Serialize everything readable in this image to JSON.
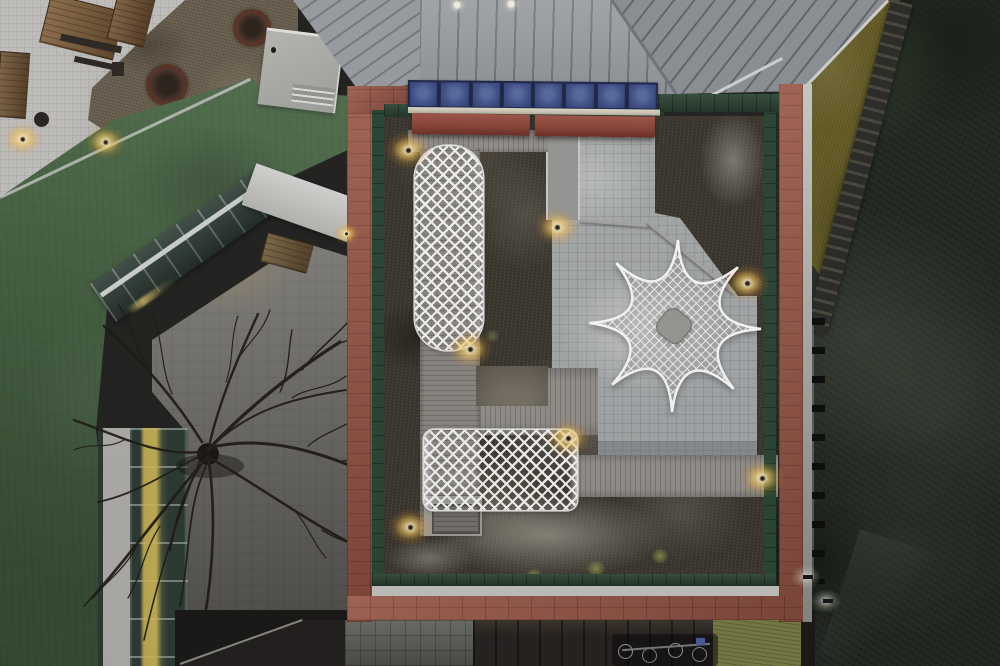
{
  "scene": {
    "description": "Dusk aerial drone photograph looking straight down at a school rooftop courtyard framed by a brick-red roof border, containing white lattice canopy structures (a long tunnel, a low rectangle and an eight-point star pavilion), pale tile paving, wooden deck paths, dry winter roof-garden beds and warm path lights; surrounded by a green sports turf, a glass atrium wing with a bare tree over a paver courtyard, a standing-seam metal roof, and a dark wooded hillside with an access stair",
    "time_of_day": "dusk",
    "view": "top-down aerial",
    "season": "winter"
  },
  "palette": {
    "metal_roof": "#9da0a3",
    "metal_roof_dark": "#909396",
    "roof_border_red": "#9c5846",
    "awning_red": "#8e4435",
    "panel_blue": "#42528b",
    "fence_green": "#2d4733",
    "turf_green": "#4a6943",
    "tile_gray": "#b4b5b0",
    "deck_gray": "#8e8a84",
    "vegetation_brown": "#3e392f",
    "lattice_white": "#fbfaf7",
    "light_warm": "#ffd98a",
    "plaza_gray": "#c6c4bf",
    "hillside_dark": "#242a20",
    "olive_slope": "#6b6128",
    "glass_green": "#35443b",
    "courtyard_gray": "#7e7b74"
  },
  "counts": {
    "blue_panels": 8,
    "courtyard_lights": 7,
    "plaza_lights": 2,
    "perimeter_lamps": 2,
    "rooftop_lamp_dots": 2,
    "lattice_structures": 3
  },
  "lights": {
    "courtyard": [
      [
        408,
        150
      ],
      [
        557,
        227
      ],
      [
        470,
        349
      ],
      [
        568,
        438
      ],
      [
        410,
        527
      ],
      [
        747,
        283
      ],
      [
        762,
        478
      ]
    ],
    "plaza": [
      [
        20,
        137
      ],
      [
        103,
        140
      ]
    ],
    "canopy": [
      [
        337,
        226
      ]
    ],
    "perimeter": [
      [
        806,
        577
      ],
      [
        826,
        601
      ]
    ],
    "roof_dots": [
      [
        457,
        5
      ],
      [
        511,
        4
      ]
    ]
  }
}
